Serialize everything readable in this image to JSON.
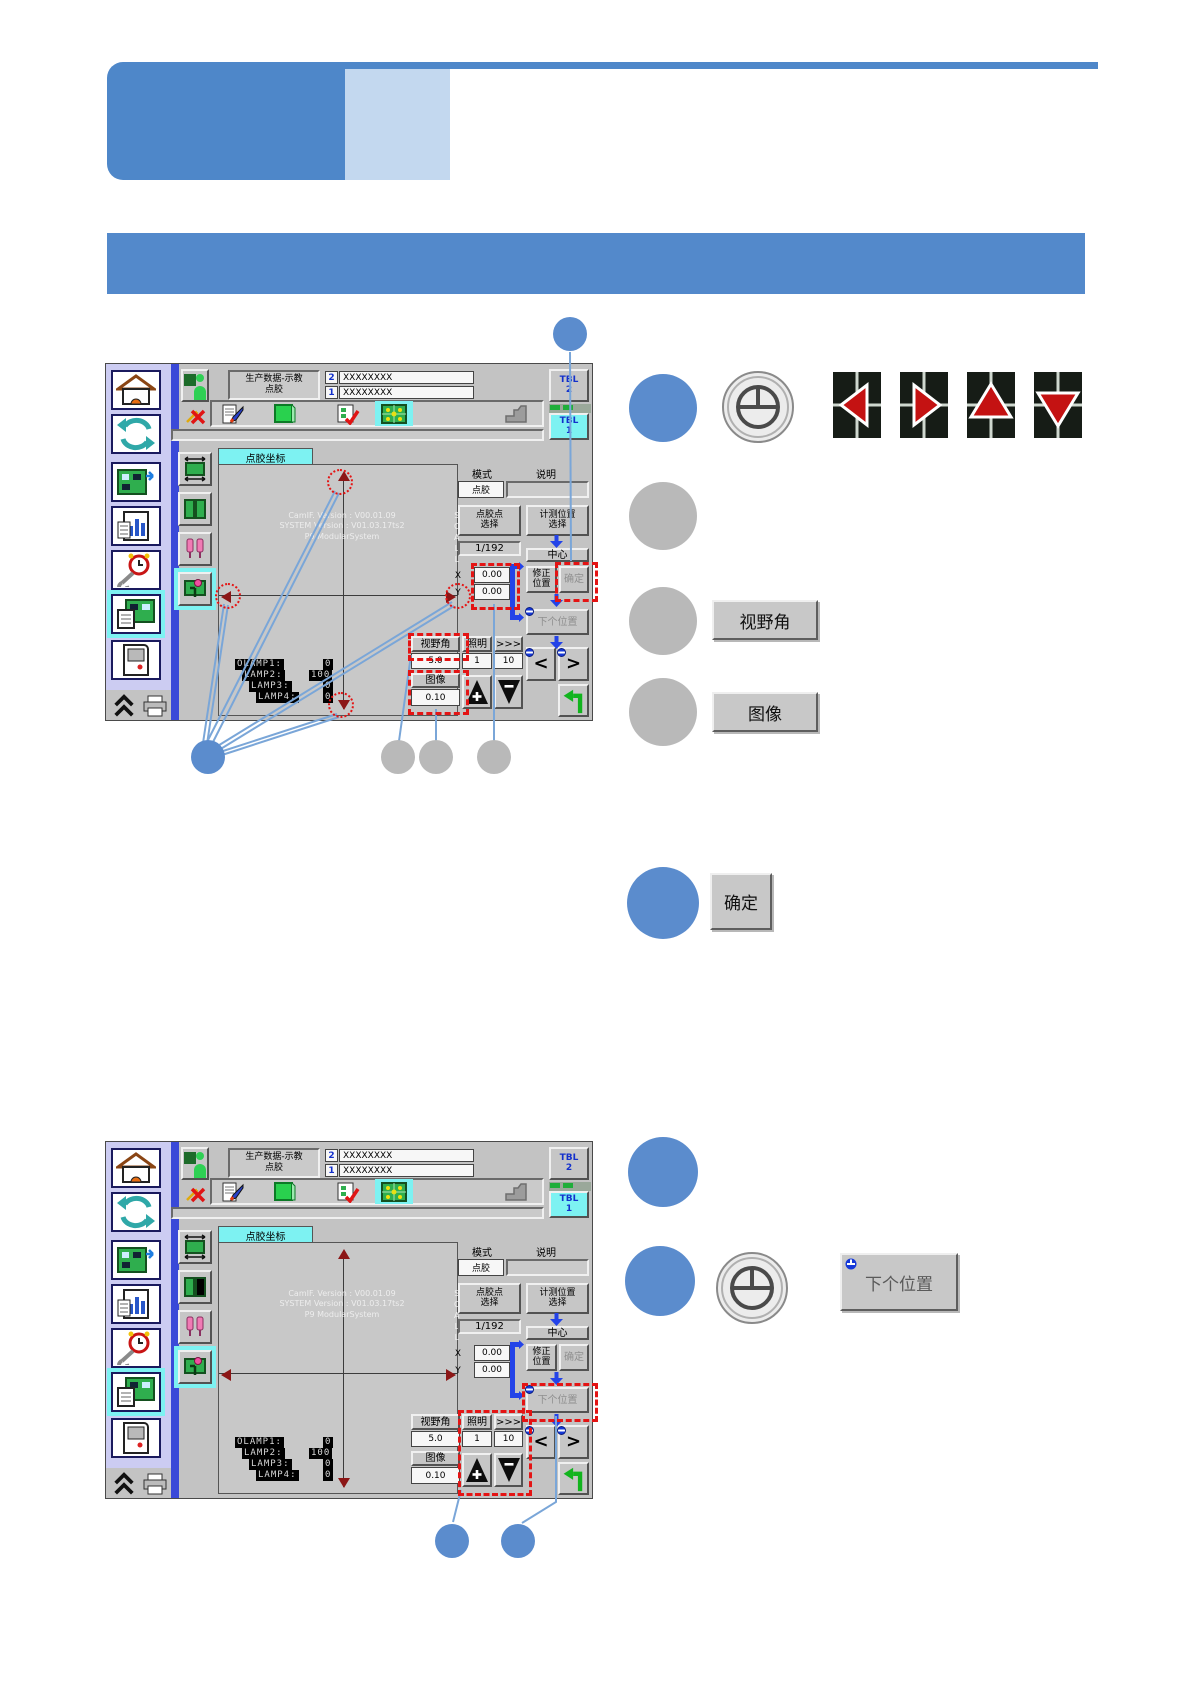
{
  "colors": {
    "accent_blue": "#5b8ccd",
    "callout_gray": "#b9b9b9",
    "banner_blue": "#4e87c9",
    "banner_light": "#c3d8ef",
    "section_bar_blue": "#5389cb",
    "highlight_cyan": "#7df2f2",
    "alert_red": "#e41414"
  },
  "ui": {
    "header": {
      "title_line1": "生产数据-示教",
      "title_line2": "点胶",
      "slot2_num": "2",
      "slot2_value": "XXXXXXXX",
      "slot1_num": "1",
      "slot1_value": "XXXXXXXX",
      "tbl_label": "TBL",
      "tbl2_num": "2",
      "tbl1_num": "1"
    },
    "tab_label": "点胶坐标",
    "canvas": {
      "version_line1": "CamIF. Version : V00.01.09",
      "version_line2": "SYSTEM Version : V01.03.17ts2",
      "version_line3": "P9 ModularSystem",
      "lamps": [
        {
          "name": "OLAMP1:",
          "value": "0"
        },
        {
          "name": "LAMP2:",
          "value": "100"
        },
        {
          "name": "LAMP3:",
          "value": "0"
        },
        {
          "name": "LAMP4:",
          "value": "0"
        }
      ]
    },
    "panel": {
      "mode_label": "模式",
      "desc_label": "说明",
      "mode_value": "点胶",
      "dispense_btn_l1": "点胶点",
      "dispense_btn_l2": "选择",
      "measure_btn_l1": "计测位置",
      "measure_btn_l2": "选择",
      "counter": "1/192",
      "center_btn": "中心",
      "x_label": "X",
      "x_value": "0.00",
      "y_label": "Y",
      "y_value": "0.00",
      "correct_btn_l1": "修正",
      "correct_btn_l2": "位置",
      "ok_btn": "确定",
      "next_btn": "下个位置",
      "fov_label": "视野角",
      "fov_value": "5.0",
      "light_label": "照明",
      "light_value": "1",
      "step_label": ">>>",
      "step_value": "10",
      "image_label": "图像",
      "image_value": "0.10",
      "side_letters": "S\nC\nA\nL\nL"
    }
  },
  "annotations": {
    "fov_button": "视野角",
    "image_button": "图像",
    "ok_button": "确定",
    "next_button": "下个位置"
  }
}
